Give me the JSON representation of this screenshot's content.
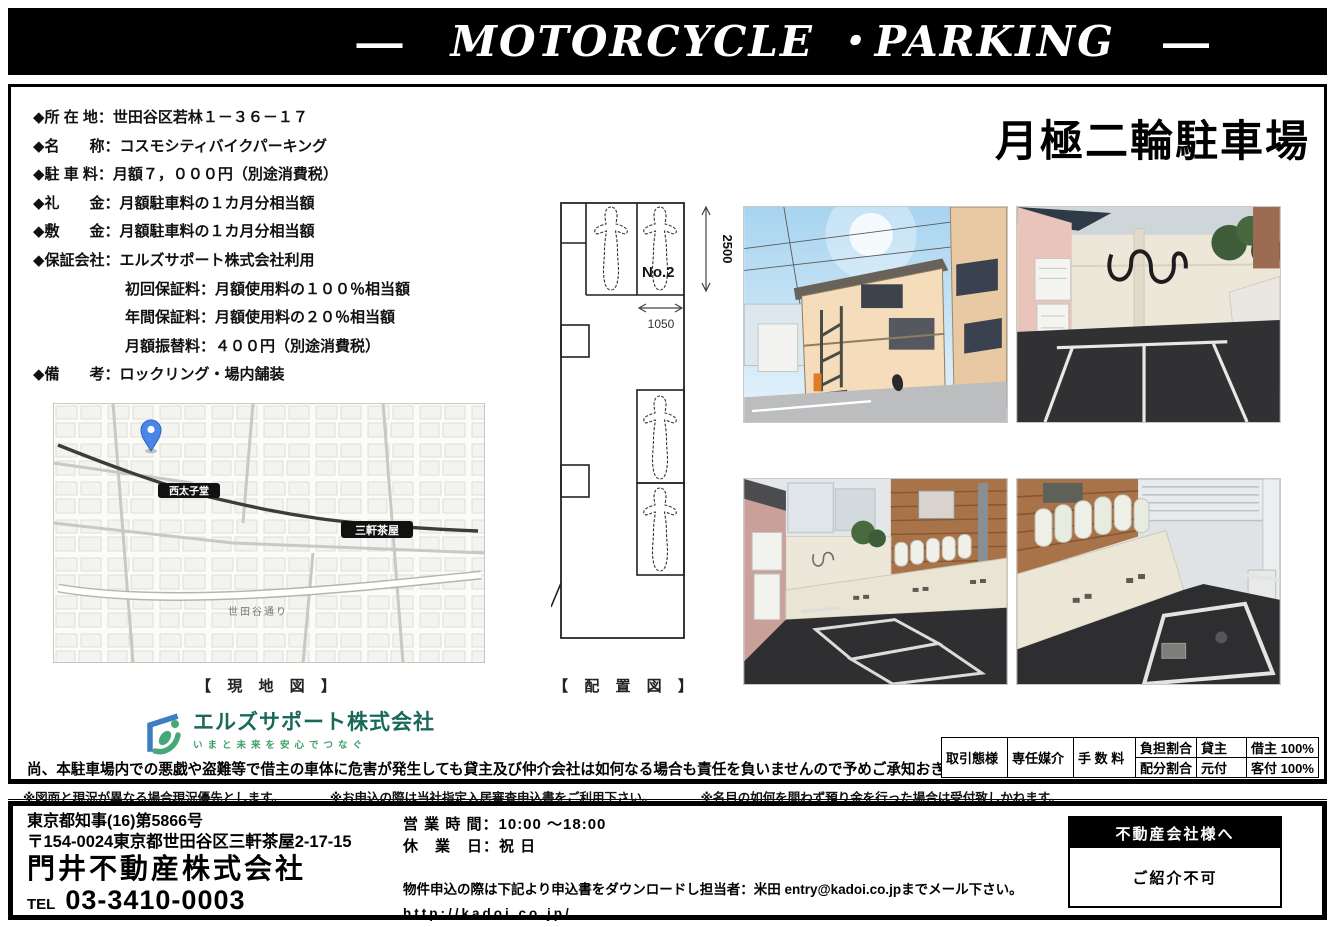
{
  "banner": {
    "dash_left": "—",
    "title": "MOTORCYCLE ・PARKING",
    "dash_right": "—"
  },
  "page_title": "月極二輪駐車場",
  "details": [
    {
      "text": "◆所 在 地：世田谷区若林１－３６－１７"
    },
    {
      "text": "◆名　　称：コスモシティバイクパーキング"
    },
    {
      "text": "◆駐 車 料：月額７，０００円（別途消費税）"
    },
    {
      "text": "◆礼　　金：月額駐車料の１カ月分相当額"
    },
    {
      "text": "◆敷　　金：月額駐車料の１カ月分相当額"
    },
    {
      "text": "◆保証会社：エルズサポート株式会社利用"
    },
    {
      "text": "初回保証料：月額使用料の１００％相当額"
    },
    {
      "text": "年間保証料：月額使用料の２０％相当額"
    },
    {
      "text": "月額振替料：４００円（別途消費税）"
    },
    {
      "text": "◆備　　考：ロックリング・場内舗装"
    }
  ],
  "captions": {
    "map": "【 現 地 図 】",
    "diagram": "【 配 置 図 】"
  },
  "diagram": {
    "space_label": "No.2",
    "dim_vertical": "2500",
    "dim_horizontal": "1050"
  },
  "map": {
    "station_west": "西太子堂",
    "station_main": "三軒茶屋",
    "road": "世田谷通り"
  },
  "logo": {
    "company": "エルズサポート株式会社",
    "tagline": "いまと未来を安心でつなぐ"
  },
  "main_disclaimer": "尚、本駐車場内での悪戯や盗難等で借主の車体に危害が発生しても貸主及び仲介会社は如何なる場合も責任を負いませんので予めご承知おき下さい。",
  "deal_table": {
    "type_label": "取引態様",
    "type_value": "専任媒介",
    "fee_label": "手 数 料",
    "burden_label": "負担割合",
    "burden_value": "貸主",
    "burden_tenant": "借主 100%",
    "split_label": "配分割合",
    "split_value": "元付",
    "split_agent": "客付 100%"
  },
  "notes": [
    {
      "text": "※図面と現況が異なる場合現況優先とします。"
    },
    {
      "text": "※お申込の際は当社指定入居審査申込書をご利用下さい。"
    },
    {
      "text": "※名目の如何を問わず預り金を行った場合は受付致しかねます。"
    }
  ],
  "footer": {
    "license": "東京都知事(16)第5866号",
    "address": "〒154-0024東京都世田谷区三軒茶屋2-17-15",
    "company": "門井不動産株式会社",
    "tel_label": "TEL",
    "tel_number": "03-3410-0003",
    "hours": "営 業 時 間：10:00 ～18:00",
    "closed": "休　業　日：祝 日",
    "application_note": "物件申込の際は下記より申込書をダウンロードし担当者：米田 entry@kadoi.co.jpまでメール下さい。",
    "url": "http://kadoi.co.jp/",
    "agent_box_header": "不動産会社様へ",
    "agent_box_body": "ご紹介不可"
  },
  "colors": {
    "banner_bg": "#000000",
    "logo_blue": "#3c7ec0",
    "logo_green": "#47a877",
    "pin_blue": "#4a86e8",
    "asphalt": "#2f2f33",
    "wall_cream": "#ece6d8",
    "building_peach": "#f2d9b8",
    "siding_brown": "#a9734a",
    "sky_blue": "#b8ddf2"
  }
}
